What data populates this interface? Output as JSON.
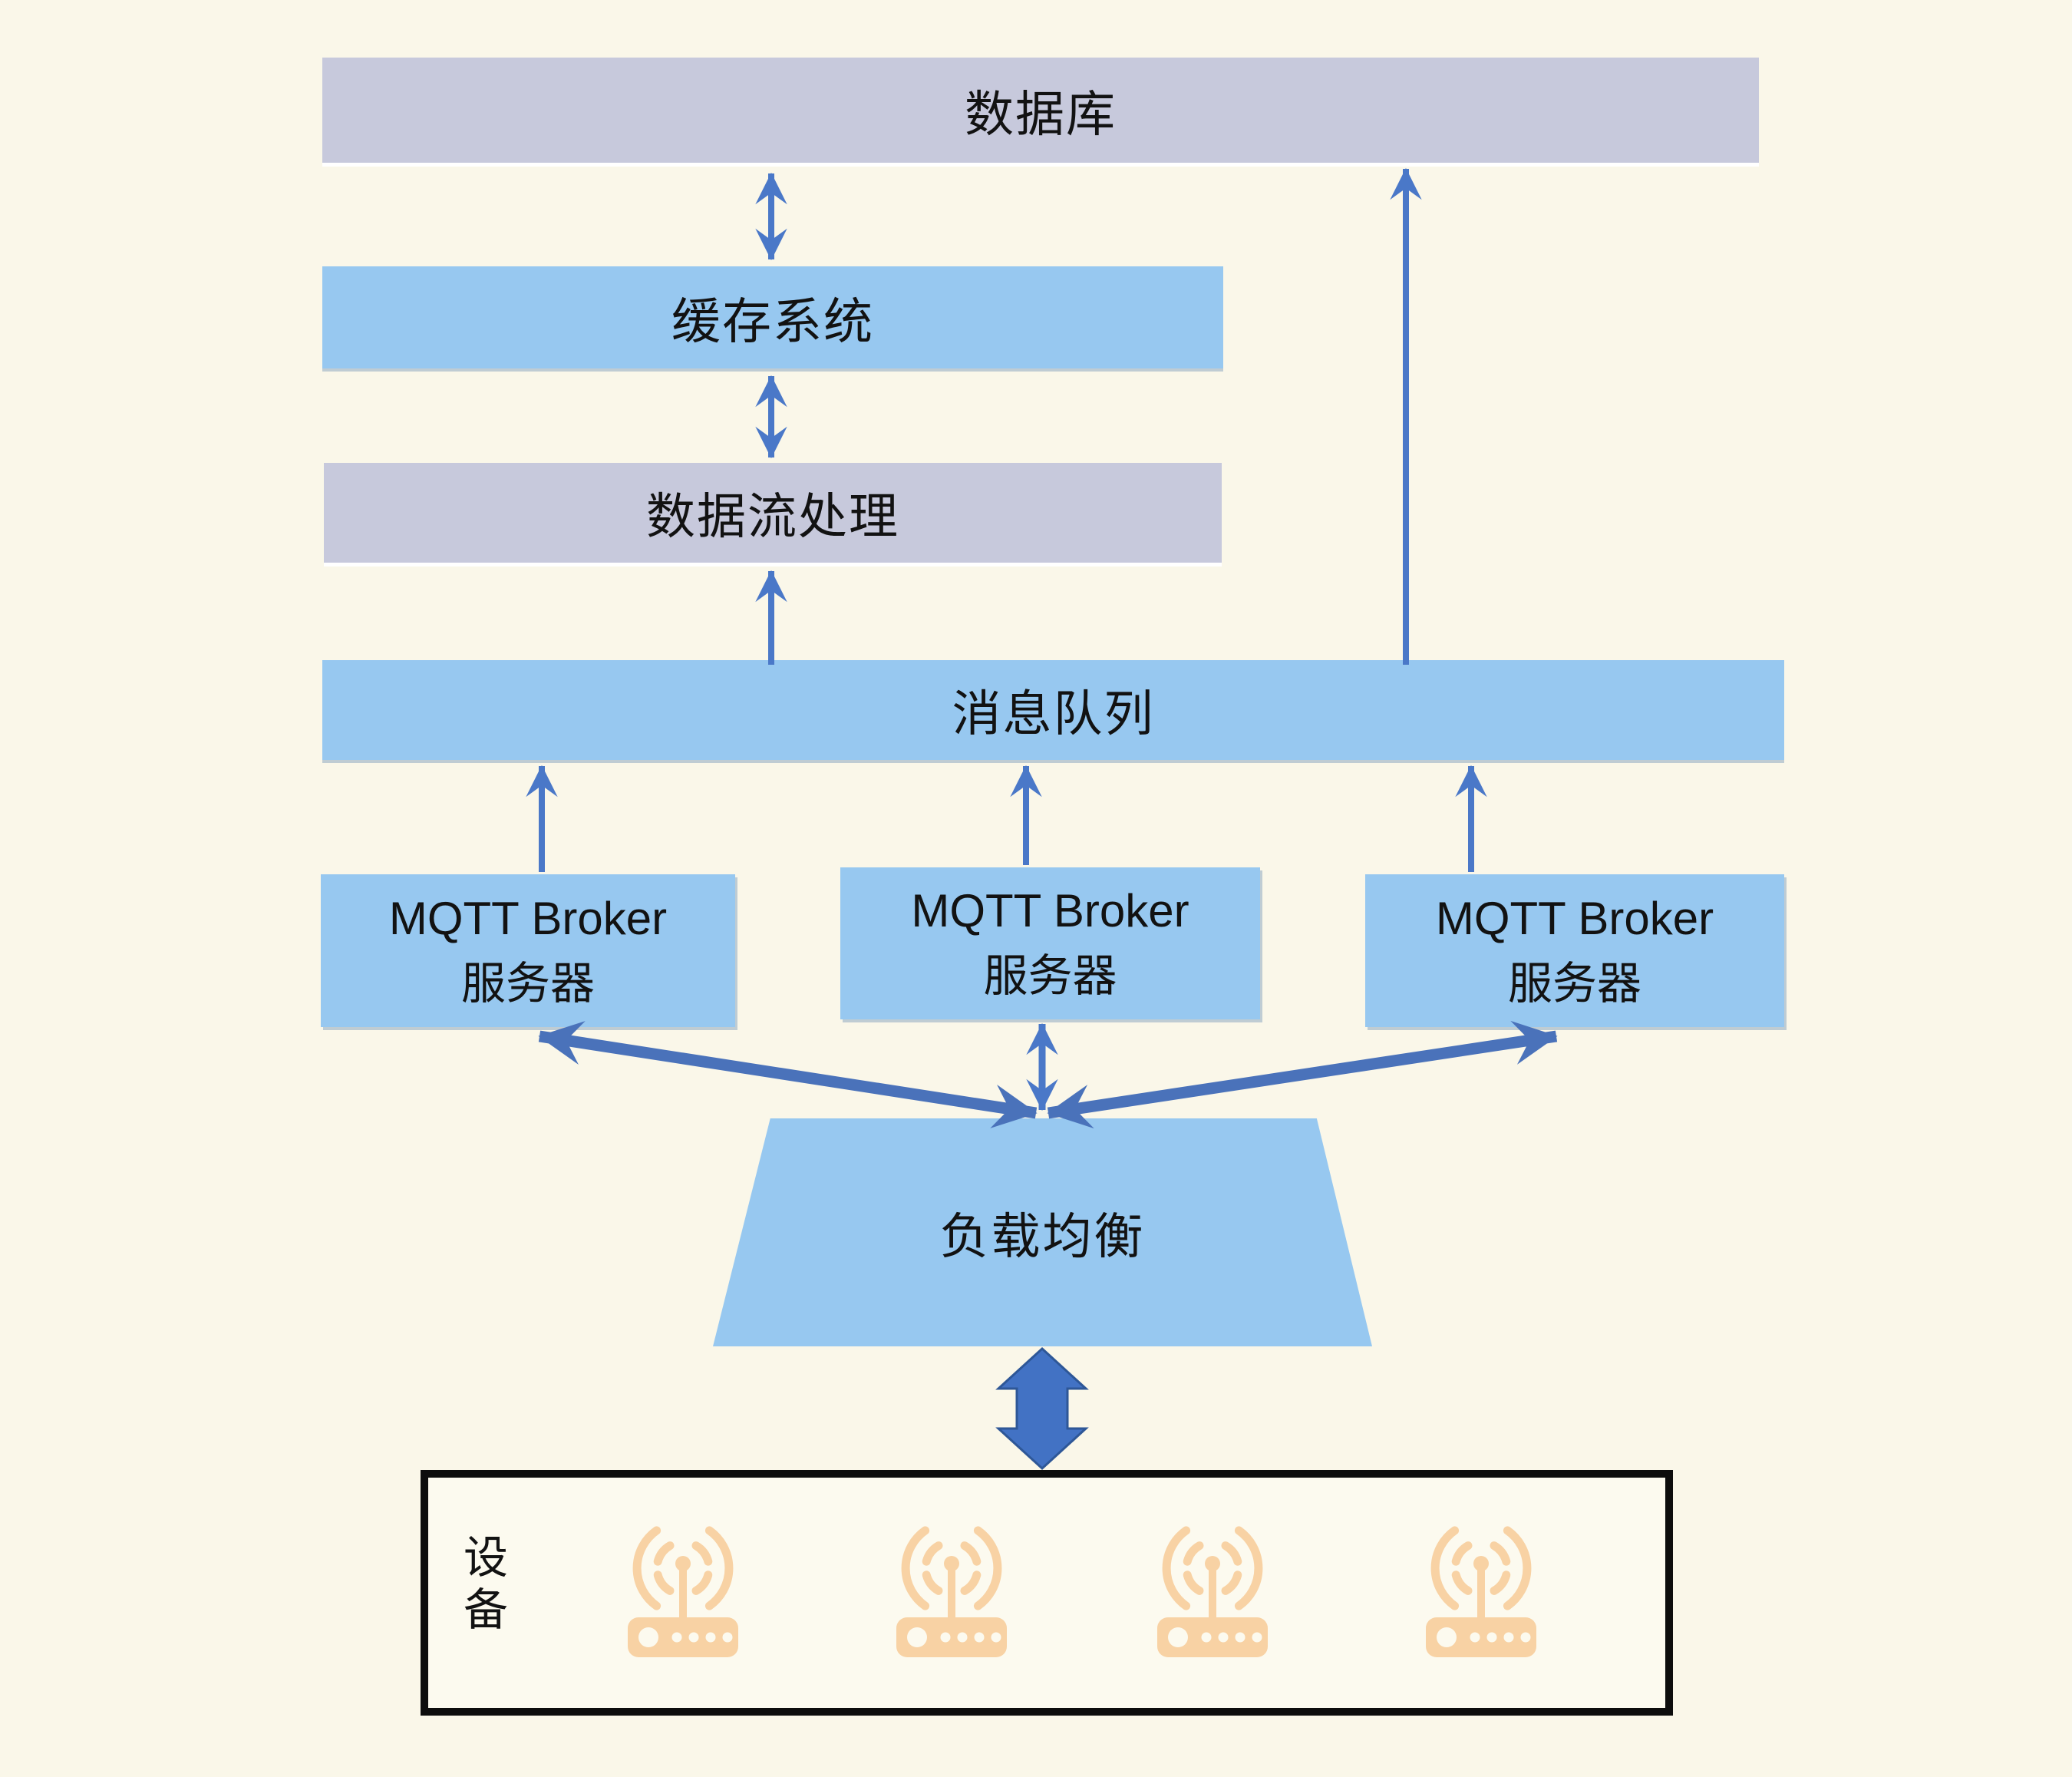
{
  "title": "MQTT 物联网系统架构图",
  "colors": {
    "c-bg": "#faf7e9",
    "c-lavender": "#c7c9dc",
    "c-blue": "#97c8f0",
    "c-text": "#121212",
    "c-arrow": "#4a78c8",
    "c-arrow-thick": "#4a72ba",
    "c-block": "#4272c4",
    "c-block-edge": "#2e5797",
    "c-orange": "#f8d2a4",
    "c-device-bg": "#fcfaef",
    "c-black": "#0d0d0d"
  },
  "nodes": {
    "database": {
      "label": "数据库"
    },
    "cache": {
      "label": "缓存系统"
    },
    "stream": {
      "label": "数据流处理"
    },
    "queue": {
      "label": "消息队列"
    },
    "brokers": [
      {
        "line1": "MQTT Broker",
        "line2": "服务器"
      },
      {
        "line1": "MQTT Broker",
        "line2": "服务器"
      },
      {
        "line1": "MQTT Broker",
        "line2": "服务器"
      }
    ],
    "load_balancer": {
      "label": "负载均衡"
    },
    "devices": {
      "label": "设备",
      "device_count": 4,
      "icon": "wifi-router-icon"
    }
  },
  "edges": [
    {
      "from": "数据库",
      "to": "缓存系统",
      "type": "bidirectional"
    },
    {
      "from": "缓存系统",
      "to": "数据流处理",
      "type": "bidirectional"
    },
    {
      "from": "消息队列",
      "to": "数据流处理",
      "type": "up"
    },
    {
      "from": "消息队列",
      "to": "数据库",
      "type": "up"
    },
    {
      "from": "MQTT Broker 服务器(左)",
      "to": "消息队列",
      "type": "up"
    },
    {
      "from": "MQTT Broker 服务器(中)",
      "to": "消息队列",
      "type": "up"
    },
    {
      "from": "MQTT Broker 服务器(右)",
      "to": "消息队列",
      "type": "up"
    },
    {
      "from": "负载均衡",
      "to": "MQTT Broker 服务器(左)",
      "type": "bidirectional"
    },
    {
      "from": "负载均衡",
      "to": "MQTT Broker 服务器(中)",
      "type": "bidirectional"
    },
    {
      "from": "负载均衡",
      "to": "MQTT Broker 服务器(右)",
      "type": "bidirectional"
    },
    {
      "from": "负载均衡",
      "to": "设备",
      "type": "bidirectional-thick"
    }
  ]
}
